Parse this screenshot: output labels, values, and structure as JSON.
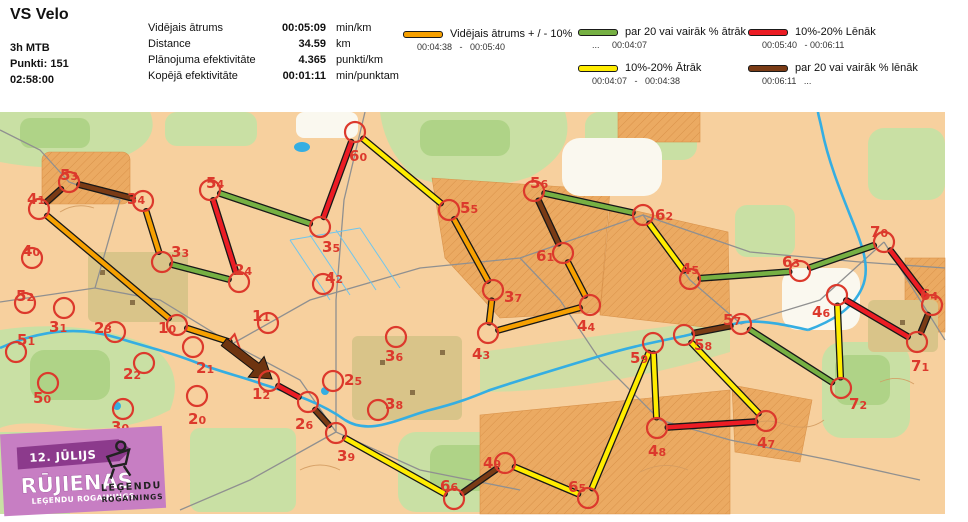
{
  "header": {
    "title": "VS Velo",
    "meta": {
      "class": "3h MTB",
      "points": "Punkti: 151",
      "time": "02:58:00"
    },
    "stats": [
      {
        "label": "Vidējais ātrums",
        "value": "00:05:09",
        "unit": "min/km"
      },
      {
        "label": "Distance",
        "value": "34.59",
        "unit": "km"
      },
      {
        "label": "Plānojuma efektivitāte",
        "value": "4.365",
        "unit": "punkti/km"
      },
      {
        "label": "Kopējā efektivitāte",
        "value": "00:01:11",
        "unit": "min/punktam"
      }
    ],
    "legend": [
      {
        "speed": "avg",
        "label": "Vidējais ātrums + / - 10%",
        "range": "00:04:38   -   00:05:40"
      },
      {
        "speed": "fast20",
        "label": "par 20 vai vairāk % ātrāk",
        "range": "...     00:04:07"
      },
      {
        "speed": "fast10",
        "label": "10%-20% Ātrāk",
        "range": "00:04:07   -   00:04:38"
      },
      {
        "speed": "slow10",
        "label": "10%-20% Lēnāk",
        "range": "00:05:40   - 00:06:11"
      },
      {
        "speed": "slow20",
        "label": "par 20 vai vairāk % lēnāk",
        "range": "00:06:11   ..."
      }
    ]
  },
  "map": {
    "colors": {
      "avg": "#F6A000",
      "fast20": "#76B043",
      "fast10": "#FFEC00",
      "slow10": "#EC1C24",
      "slow20": "#7A3B15",
      "control": "#DC392C"
    },
    "start": {
      "x": 233,
      "y": 343
    },
    "controls": [
      {
        "id": "41",
        "x": 39,
        "y": 209,
        "lx": 27,
        "ly": 204,
        "visited": true
      },
      {
        "id": "53",
        "x": 69,
        "y": 182,
        "lx": 60,
        "ly": 180,
        "visited": true
      },
      {
        "id": "34",
        "x": 143,
        "y": 201,
        "lx": 127,
        "ly": 204,
        "visited": true
      },
      {
        "id": "33",
        "x": 162,
        "y": 262,
        "lx": 171,
        "ly": 257,
        "visited": true
      },
      {
        "id": "24",
        "x": 239,
        "y": 282,
        "lx": 234,
        "ly": 275,
        "visited": true
      },
      {
        "id": "54",
        "x": 210,
        "y": 190,
        "lx": 206,
        "ly": 188,
        "visited": true
      },
      {
        "id": "35",
        "x": 320,
        "y": 227,
        "lx": 322,
        "ly": 252,
        "visited": true
      },
      {
        "id": "60",
        "x": 355,
        "y": 132,
        "lx": 349,
        "ly": 161,
        "visited": true
      },
      {
        "id": "55",
        "x": 449,
        "y": 210,
        "lx": 460,
        "ly": 213,
        "visited": true
      },
      {
        "id": "37",
        "x": 493,
        "y": 290,
        "lx": 504,
        "ly": 302,
        "visited": true
      },
      {
        "id": "43",
        "x": 488,
        "y": 333,
        "lx": 472,
        "ly": 359,
        "visited": true
      },
      {
        "id": "44",
        "x": 590,
        "y": 305,
        "lx": 577,
        "ly": 331,
        "visited": true
      },
      {
        "id": "61",
        "x": 563,
        "y": 253,
        "lx": 536,
        "ly": 261,
        "visited": true
      },
      {
        "id": "56",
        "x": 534,
        "y": 191,
        "lx": 530,
        "ly": 188,
        "visited": true
      },
      {
        "id": "62",
        "x": 643,
        "y": 215,
        "lx": 655,
        "ly": 220,
        "visited": true
      },
      {
        "id": "45",
        "x": 690,
        "y": 279,
        "lx": 681,
        "ly": 274,
        "visited": true
      },
      {
        "id": "63",
        "x": 800,
        "y": 271,
        "lx": 782,
        "ly": 267,
        "visited": true
      },
      {
        "id": "70",
        "x": 884,
        "y": 242,
        "lx": 870,
        "ly": 237,
        "visited": true
      },
      {
        "id": "64",
        "x": 932,
        "y": 305,
        "lx": 920,
        "ly": 300,
        "visited": true
      },
      {
        "id": "71",
        "x": 917,
        "y": 342,
        "lx": 911,
        "ly": 371,
        "visited": true
      },
      {
        "id": "46",
        "x": 837,
        "y": 295,
        "lx": 812,
        "ly": 317,
        "visited": true
      },
      {
        "id": "72",
        "x": 841,
        "y": 388,
        "lx": 849,
        "ly": 409,
        "visited": true
      },
      {
        "id": "57",
        "x": 741,
        "y": 324,
        "lx": 723,
        "ly": 325,
        "visited": true
      },
      {
        "id": "58",
        "x": 684,
        "y": 335,
        "lx": 694,
        "ly": 350,
        "visited": true
      },
      {
        "id": "59",
        "x": 653,
        "y": 343,
        "lx": 630,
        "ly": 363,
        "visited": true
      },
      {
        "id": "48",
        "x": 657,
        "y": 428,
        "lx": 648,
        "ly": 456,
        "visited": true
      },
      {
        "id": "47",
        "x": 766,
        "y": 421,
        "lx": 757,
        "ly": 448,
        "visited": true
      },
      {
        "id": "65",
        "x": 588,
        "y": 498,
        "lx": 568,
        "ly": 492,
        "visited": true
      },
      {
        "id": "49",
        "x": 505,
        "y": 463,
        "lx": 483,
        "ly": 468,
        "visited": true
      },
      {
        "id": "66",
        "x": 454,
        "y": 499,
        "lx": 440,
        "ly": 491,
        "visited": true
      },
      {
        "id": "39",
        "x": 336,
        "y": 433,
        "lx": 337,
        "ly": 461,
        "visited": true
      },
      {
        "id": "26",
        "x": 308,
        "y": 402,
        "lx": 295,
        "ly": 429,
        "visited": true
      },
      {
        "id": "12",
        "x": 269,
        "y": 381,
        "lx": 252,
        "ly": 399,
        "visited": true
      },
      {
        "id": "10",
        "x": 177,
        "y": 325,
        "lx": 158,
        "ly": 333,
        "visited": true
      },
      {
        "id": "40",
        "x": 32,
        "y": 258,
        "lx": 22,
        "ly": 256,
        "visited": false
      },
      {
        "id": "52",
        "x": 25,
        "y": 303,
        "lx": 16,
        "ly": 301,
        "visited": false
      },
      {
        "id": "31",
        "x": 64,
        "y": 308,
        "lx": 49,
        "ly": 332,
        "visited": false
      },
      {
        "id": "51",
        "x": 16,
        "y": 352,
        "lx": 17,
        "ly": 345,
        "visited": false
      },
      {
        "id": "23",
        "x": 115,
        "y": 332,
        "lx": 94,
        "ly": 333,
        "visited": false
      },
      {
        "id": "22",
        "x": 144,
        "y": 363,
        "lx": 123,
        "ly": 379,
        "visited": false
      },
      {
        "id": "50",
        "x": 48,
        "y": 383,
        "lx": 33,
        "ly": 403,
        "visited": false
      },
      {
        "id": "30",
        "x": 123,
        "y": 409,
        "lx": 111,
        "ly": 432,
        "visited": false
      },
      {
        "id": "21",
        "x": 193,
        "y": 347,
        "lx": 196,
        "ly": 373,
        "visited": false
      },
      {
        "id": "20",
        "x": 197,
        "y": 396,
        "lx": 188,
        "ly": 424,
        "visited": false
      },
      {
        "id": "11",
        "x": 268,
        "y": 323,
        "lx": 252,
        "ly": 321,
        "visited": false
      },
      {
        "id": "42",
        "x": 323,
        "y": 284,
        "lx": 325,
        "ly": 283,
        "visited": false
      },
      {
        "id": "25",
        "x": 333,
        "y": 381,
        "lx": 344,
        "ly": 385,
        "visited": false
      },
      {
        "id": "36",
        "x": 396,
        "y": 337,
        "lx": 385,
        "ly": 361,
        "visited": false
      },
      {
        "id": "38",
        "x": 378,
        "y": 410,
        "lx": 385,
        "ly": 409,
        "visited": false
      }
    ],
    "legs": [
      {
        "from": "12",
        "to": "26",
        "speed": "slow10"
      },
      {
        "from": "26",
        "to": "39",
        "speed": "slow20"
      },
      {
        "from": "39",
        "to": "66",
        "speed": "fast10"
      },
      {
        "from": "66",
        "to": "49",
        "speed": "slow20"
      },
      {
        "from": "49",
        "to": "65",
        "speed": "fast10"
      },
      {
        "from": "65",
        "to": "59",
        "speed": "fast10"
      },
      {
        "from": "59",
        "to": "48",
        "speed": "fast10"
      },
      {
        "from": "48",
        "to": "47",
        "speed": "slow10"
      },
      {
        "from": "47",
        "to": "58",
        "speed": "fast10"
      },
      {
        "from": "58",
        "to": "57",
        "speed": "slow20"
      },
      {
        "from": "57",
        "to": "72",
        "speed": "fast20"
      },
      {
        "from": "72",
        "to": "46",
        "speed": "fast10"
      },
      {
        "from": "46",
        "to": "71",
        "speed": "slow10"
      },
      {
        "from": "71",
        "to": "64",
        "speed": "slow20"
      },
      {
        "from": "64",
        "to": "70",
        "speed": "slow10"
      },
      {
        "from": "70",
        "to": "63",
        "speed": "fast20"
      },
      {
        "from": "63",
        "to": "45",
        "speed": "fast20"
      },
      {
        "from": "45",
        "to": "62",
        "speed": "fast10"
      },
      {
        "from": "62",
        "to": "56",
        "speed": "fast20"
      },
      {
        "from": "56",
        "to": "61",
        "speed": "slow20"
      },
      {
        "from": "61",
        "to": "44",
        "speed": "avg"
      },
      {
        "from": "44",
        "to": "43",
        "speed": "avg"
      },
      {
        "from": "43",
        "to": "37",
        "speed": "avg"
      },
      {
        "from": "37",
        "to": "55",
        "speed": "avg"
      },
      {
        "from": "55",
        "to": "60",
        "speed": "fast10"
      },
      {
        "from": "60",
        "to": "35",
        "speed": "slow10"
      },
      {
        "from": "35",
        "to": "54",
        "speed": "fast20"
      },
      {
        "from": "54",
        "to": "24",
        "speed": "slow10"
      },
      {
        "from": "24",
        "to": "33",
        "speed": "fast20"
      },
      {
        "from": "33",
        "to": "34",
        "speed": "avg"
      },
      {
        "from": "34",
        "to": "53",
        "speed": "slow20"
      },
      {
        "from": "53",
        "to": "41",
        "speed": "slow20"
      },
      {
        "from": "41",
        "to": "10",
        "speed": "avg"
      },
      {
        "from": "10",
        "to": "start",
        "speed": "avg"
      }
    ],
    "finish_arrow": {
      "from": "start",
      "to": "12",
      "speed": "slow20"
    },
    "logo": {
      "date": "12. JŪLIJS",
      "title": "RŪJIENAS",
      "subtitle": "LEĢENDU ROGAININGS",
      "brand_line1": "LEĢENDU",
      "brand_line2": "ROGAININGS"
    }
  }
}
